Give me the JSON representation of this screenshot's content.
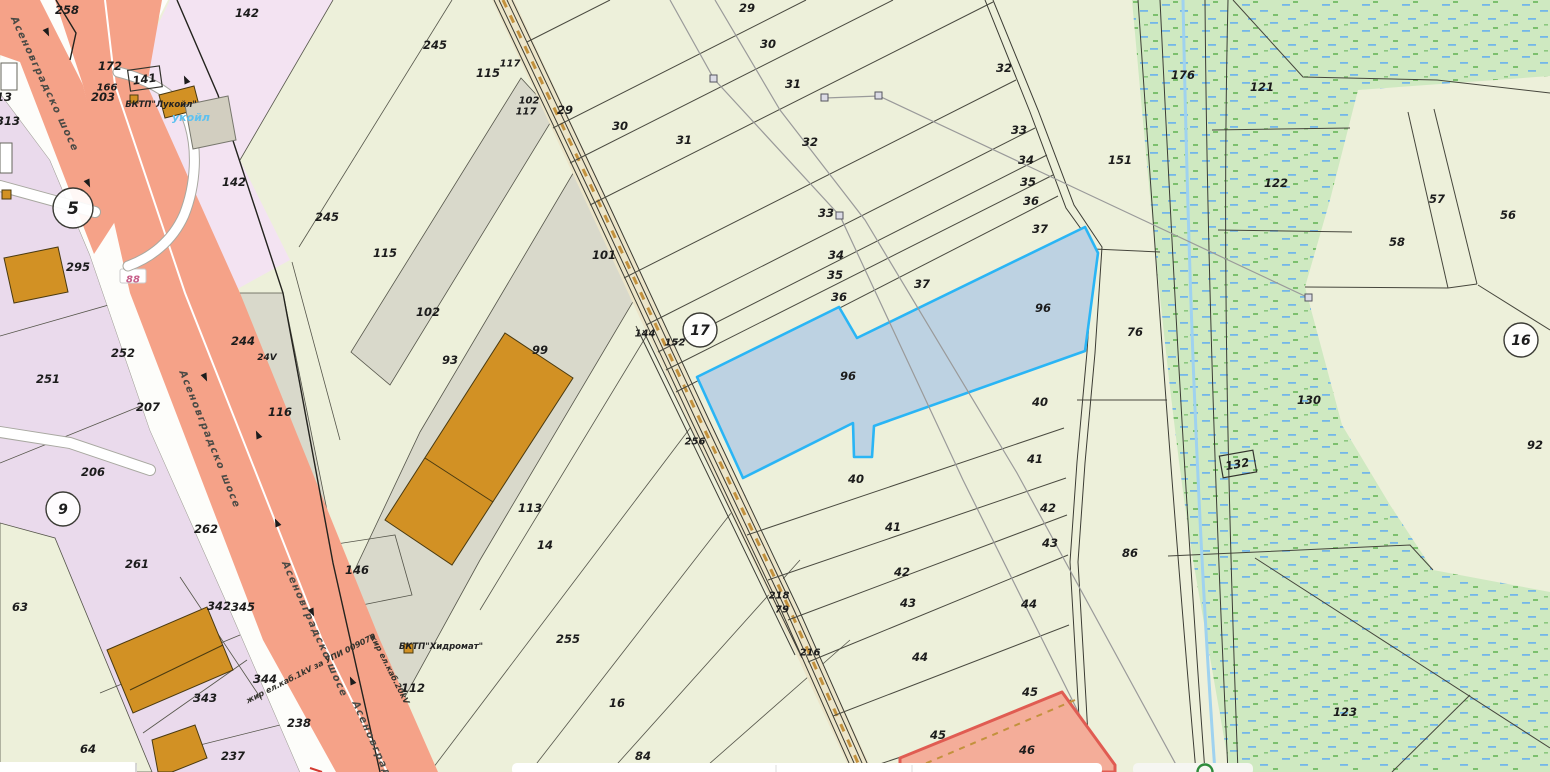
{
  "map": {
    "type": "cadastral-map",
    "colors": {
      "base_parcel": "#edf0da",
      "lavender_parcel": "#eadaec",
      "pink_parcel": "#f3e3f2",
      "gray_parcel": "#d9d9cb",
      "highway_salmon": "#f5a288",
      "dirt_road_fill": "#ece5c9",
      "dirt_road_dash": "#c3913d",
      "selected_parcel_fill": "#bdd2e2",
      "selected_parcel_stroke": "#2ab5f5",
      "vegetation_fill": "#cfe9c1",
      "stream_blue": "#9fd2ef",
      "red_strip_stroke": "#e05c52",
      "label_color": "#1c1c1c"
    },
    "parcel_labels": [
      {
        "t": "258",
        "x": 67,
        "y": 10
      },
      {
        "t": "142",
        "x": 247,
        "y": 13
      },
      {
        "t": "245",
        "x": 435,
        "y": 45
      },
      {
        "t": "115",
        "x": 488,
        "y": 73
      },
      {
        "t": "117",
        "x": 510,
        "y": 63,
        "s": 10
      },
      {
        "t": "102",
        "x": 529,
        "y": 100,
        "s": 10
      },
      {
        "t": "117",
        "x": 526,
        "y": 111,
        "s": 10
      },
      {
        "t": "29",
        "x": 565,
        "y": 110
      },
      {
        "t": "29",
        "x": 747,
        "y": 8
      },
      {
        "t": "30",
        "x": 768,
        "y": 44
      },
      {
        "t": "31",
        "x": 793,
        "y": 84
      },
      {
        "t": "32",
        "x": 1004,
        "y": 68
      },
      {
        "t": "30",
        "x": 620,
        "y": 126
      },
      {
        "t": "31",
        "x": 684,
        "y": 140
      },
      {
        "t": "32",
        "x": 810,
        "y": 142
      },
      {
        "t": "33",
        "x": 1019,
        "y": 130
      },
      {
        "t": "33",
        "x": 826,
        "y": 213
      },
      {
        "t": "34",
        "x": 1026,
        "y": 160
      },
      {
        "t": "35",
        "x": 1028,
        "y": 182
      },
      {
        "t": "36",
        "x": 1031,
        "y": 201
      },
      {
        "t": "37",
        "x": 1040,
        "y": 229
      },
      {
        "t": "34",
        "x": 836,
        "y": 255
      },
      {
        "t": "35",
        "x": 835,
        "y": 275
      },
      {
        "t": "36",
        "x": 839,
        "y": 297
      },
      {
        "t": "37",
        "x": 922,
        "y": 284
      },
      {
        "t": "151",
        "x": 1120,
        "y": 160
      },
      {
        "t": "176",
        "x": 1183,
        "y": 75
      },
      {
        "t": "121",
        "x": 1262,
        "y": 87
      },
      {
        "t": "122",
        "x": 1276,
        "y": 183
      },
      {
        "t": "57",
        "x": 1437,
        "y": 199
      },
      {
        "t": "56",
        "x": 1508,
        "y": 215
      },
      {
        "t": "58",
        "x": 1397,
        "y": 242
      },
      {
        "t": "96",
        "x": 1043,
        "y": 308
      },
      {
        "t": "96",
        "x": 848,
        "y": 376
      },
      {
        "t": "101",
        "x": 604,
        "y": 255
      },
      {
        "t": "245",
        "x": 327,
        "y": 217
      },
      {
        "t": "115",
        "x": 385,
        "y": 253
      },
      {
        "t": "102",
        "x": 428,
        "y": 312
      },
      {
        "t": "93",
        "x": 450,
        "y": 360
      },
      {
        "t": "99",
        "x": 540,
        "y": 350
      },
      {
        "t": "244",
        "x": 243,
        "y": 341
      },
      {
        "t": "24V",
        "x": 267,
        "y": 357,
        "s": 9
      },
      {
        "t": "116",
        "x": 280,
        "y": 412
      },
      {
        "t": "252",
        "x": 123,
        "y": 353
      },
      {
        "t": "295",
        "x": 78,
        "y": 267
      },
      {
        "t": "207",
        "x": 148,
        "y": 407
      },
      {
        "t": "251",
        "x": 48,
        "y": 379
      },
      {
        "t": "206",
        "x": 93,
        "y": 472
      },
      {
        "t": "262",
        "x": 206,
        "y": 529
      },
      {
        "t": "261",
        "x": 137,
        "y": 564
      },
      {
        "t": "63",
        "x": 20,
        "y": 607
      },
      {
        "t": "64",
        "x": 88,
        "y": 749
      },
      {
        "t": "342",
        "x": 219,
        "y": 606
      },
      {
        "t": "345",
        "x": 243,
        "y": 607
      },
      {
        "t": "344",
        "x": 265,
        "y": 679
      },
      {
        "t": "343",
        "x": 205,
        "y": 698
      },
      {
        "t": "237",
        "x": 233,
        "y": 756
      },
      {
        "t": "238",
        "x": 299,
        "y": 723
      },
      {
        "t": "146",
        "x": 357,
        "y": 570
      },
      {
        "t": "113",
        "x": 530,
        "y": 508
      },
      {
        "t": "14",
        "x": 545,
        "y": 545
      },
      {
        "t": "112",
        "x": 413,
        "y": 688
      },
      {
        "t": "255",
        "x": 568,
        "y": 639
      },
      {
        "t": "16",
        "x": 617,
        "y": 703
      },
      {
        "t": "84",
        "x": 643,
        "y": 756
      },
      {
        "t": "144",
        "x": 645,
        "y": 333,
        "s": 10
      },
      {
        "t": "152",
        "x": 675,
        "y": 342,
        "s": 10
      },
      {
        "t": "256",
        "x": 695,
        "y": 441,
        "s": 10
      },
      {
        "t": "76",
        "x": 1135,
        "y": 332
      },
      {
        "t": "130",
        "x": 1309,
        "y": 400
      },
      {
        "t": "92",
        "x": 1535,
        "y": 445
      },
      {
        "t": "40",
        "x": 1040,
        "y": 402
      },
      {
        "t": "40",
        "x": 856,
        "y": 479
      },
      {
        "t": "41",
        "x": 1035,
        "y": 459
      },
      {
        "t": "41",
        "x": 893,
        "y": 527
      },
      {
        "t": "42",
        "x": 1048,
        "y": 508
      },
      {
        "t": "42",
        "x": 902,
        "y": 572
      },
      {
        "t": "43",
        "x": 1050,
        "y": 543
      },
      {
        "t": "43",
        "x": 908,
        "y": 603
      },
      {
        "t": "44",
        "x": 1029,
        "y": 604
      },
      {
        "t": "44",
        "x": 920,
        "y": 657
      },
      {
        "t": "86",
        "x": 1130,
        "y": 553
      },
      {
        "t": "45",
        "x": 1030,
        "y": 692
      },
      {
        "t": "45",
        "x": 938,
        "y": 735
      },
      {
        "t": "46",
        "x": 1027,
        "y": 750
      },
      {
        "t": "123",
        "x": 1345,
        "y": 712
      },
      {
        "t": "218",
        "x": 779,
        "y": 595,
        "s": 10
      },
      {
        "t": "79",
        "x": 782,
        "y": 609,
        "s": 10
      },
      {
        "t": "216",
        "x": 810,
        "y": 652,
        "s": 10
      },
      {
        "t": "172",
        "x": 110,
        "y": 66
      },
      {
        "t": "166",
        "x": 107,
        "y": 87,
        "s": 10
      },
      {
        "t": "203",
        "x": 103,
        "y": 97
      },
      {
        "t": "313",
        "x": 8,
        "y": 121
      },
      {
        "t": "13",
        "x": 4,
        "y": 97
      },
      {
        "t": "142",
        "x": 234,
        "y": 182
      }
    ],
    "block_numbers": [
      {
        "t": "5",
        "x": 73,
        "y": 208,
        "r": 20
      },
      {
        "t": "9",
        "x": 63,
        "y": 509,
        "r": 17
      },
      {
        "t": "17",
        "x": 700,
        "y": 330,
        "r": 17
      },
      {
        "t": "16",
        "x": 1521,
        "y": 340,
        "r": 17
      }
    ],
    "boxed_labels": [
      {
        "t": "141",
        "x": 145,
        "y": 79,
        "rot": -8
      },
      {
        "t": "132",
        "x": 1238,
        "y": 464,
        "rot": -10
      }
    ],
    "road_plate": {
      "t": "88",
      "x": 133,
      "y": 279
    },
    "poi_labels": [
      {
        "t": "БКТП\"Лукойл\"",
        "x": 161,
        "y": 104,
        "s": 8.5,
        "c": "#222222"
      },
      {
        "t": "укойл",
        "x": 191,
        "y": 117,
        "s": 11,
        "c": "#5ec1f0"
      },
      {
        "t": "БКТП\"Хидромат\"",
        "x": 441,
        "y": 646,
        "s": 8.5,
        "c": "#222222"
      }
    ],
    "road_name_labels": [
      {
        "t": "Асеновградско шосе",
        "x": 42,
        "y": 82,
        "rot": 65
      },
      {
        "t": "Асеновградско шосе",
        "x": 207,
        "y": 437,
        "rot": 68
      },
      {
        "t": "Асеновградско шосе",
        "x": 312,
        "y": 627,
        "rot": 66
      },
      {
        "t": "Асеновградско",
        "x": 374,
        "y": 748,
        "rot": 66
      }
    ],
    "cable_labels": [
      {
        "t": "жир ел.каб.1kV за УПИ 009070",
        "x": 312,
        "y": 668,
        "rot": -27
      },
      {
        "t": "жир ел.каб.20kV",
        "x": 387,
        "y": 667,
        "rot": 63
      }
    ],
    "selected_parcel_number": "96"
  },
  "ui": {
    "bottom_bars": {
      "left_bar": "",
      "center_bar": "",
      "right_bar_with_logo": ""
    }
  }
}
